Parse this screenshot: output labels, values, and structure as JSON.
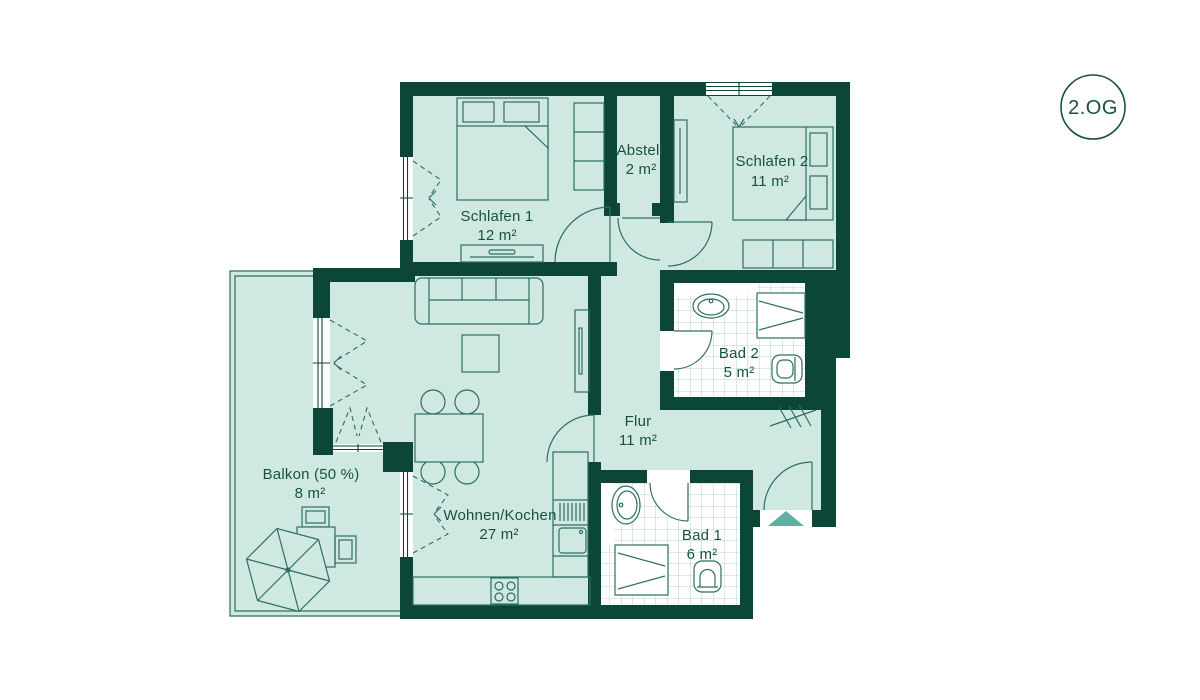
{
  "floor_badge": {
    "label": "2.OG"
  },
  "rooms": {
    "schlafen1": {
      "name": "Schlafen 1",
      "area": "12 m²"
    },
    "abstell": {
      "name": "Abstell.",
      "area": "2 m²"
    },
    "schlafen2": {
      "name": "Schlafen 2",
      "area": "11 m²"
    },
    "bad2": {
      "name": "Bad 2",
      "area": "5 m²"
    },
    "flur": {
      "name": "Flur",
      "area": "11 m²"
    },
    "bad1": {
      "name": "Bad 1",
      "area": "6 m²"
    },
    "wohnen_kochen": {
      "name": "Wohnen/Kochen",
      "area": "27 m²"
    },
    "balkon": {
      "name": "Balkon (50 %)",
      "area": "8 m²"
    }
  },
  "colors": {
    "wall": "#0b4636",
    "floor": "#cfe9e2",
    "outline": "#2e6e5e",
    "text": "#19513f",
    "tile_line": "#b7d6cc",
    "entrance_marker": "#5fb0a0",
    "background": "#ffffff"
  }
}
